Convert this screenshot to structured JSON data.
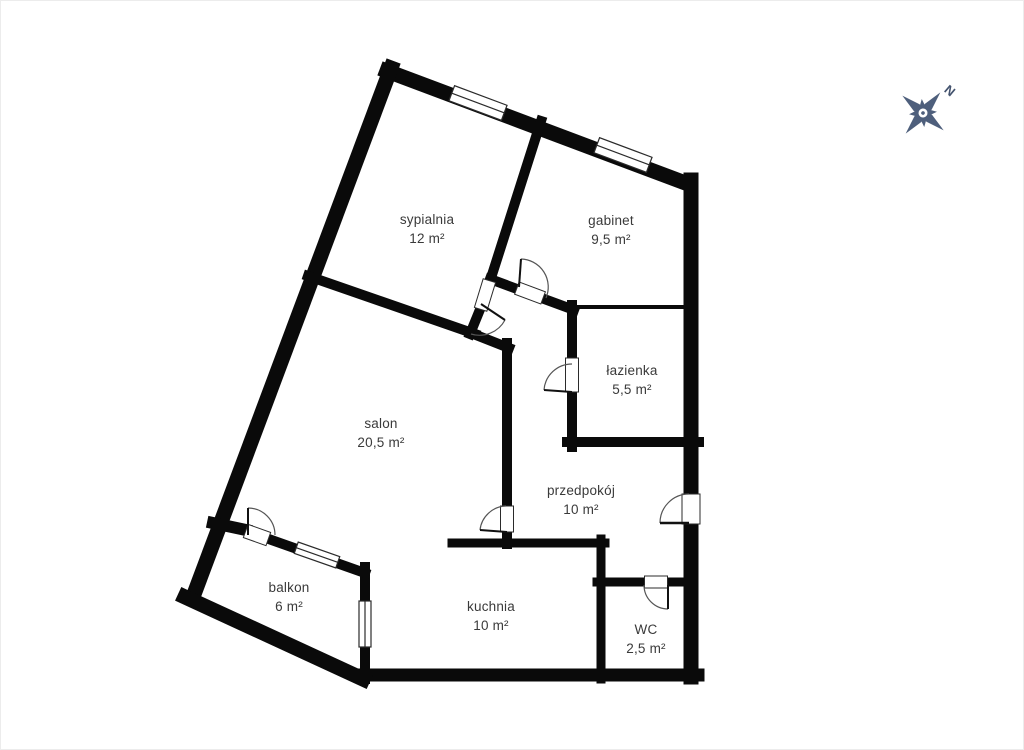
{
  "plan": {
    "rooms": [
      {
        "id": "sypialnia",
        "name": "sypialnia",
        "area": "12 m²"
      },
      {
        "id": "gabinet",
        "name": "gabinet",
        "area": "9,5 m²"
      },
      {
        "id": "lazienka",
        "name": "łazienka",
        "area": "5,5 m²"
      },
      {
        "id": "salon",
        "name": "salon",
        "area": "20,5 m²"
      },
      {
        "id": "przedpokoj",
        "name": "przedpokój",
        "area": "10 m²"
      },
      {
        "id": "balkon",
        "name": "balkon",
        "area": "6 m²"
      },
      {
        "id": "kuchnia",
        "name": "kuchnia",
        "area": "10 m²"
      },
      {
        "id": "wc",
        "name": "WC",
        "area": "2,5 m²"
      }
    ]
  },
  "compass": {
    "north_label": "N"
  },
  "colors": {
    "wall": "#0a0a0a",
    "compass": "#4e5f7c",
    "label_text": "#3a3a3a",
    "background": "#ffffff"
  }
}
